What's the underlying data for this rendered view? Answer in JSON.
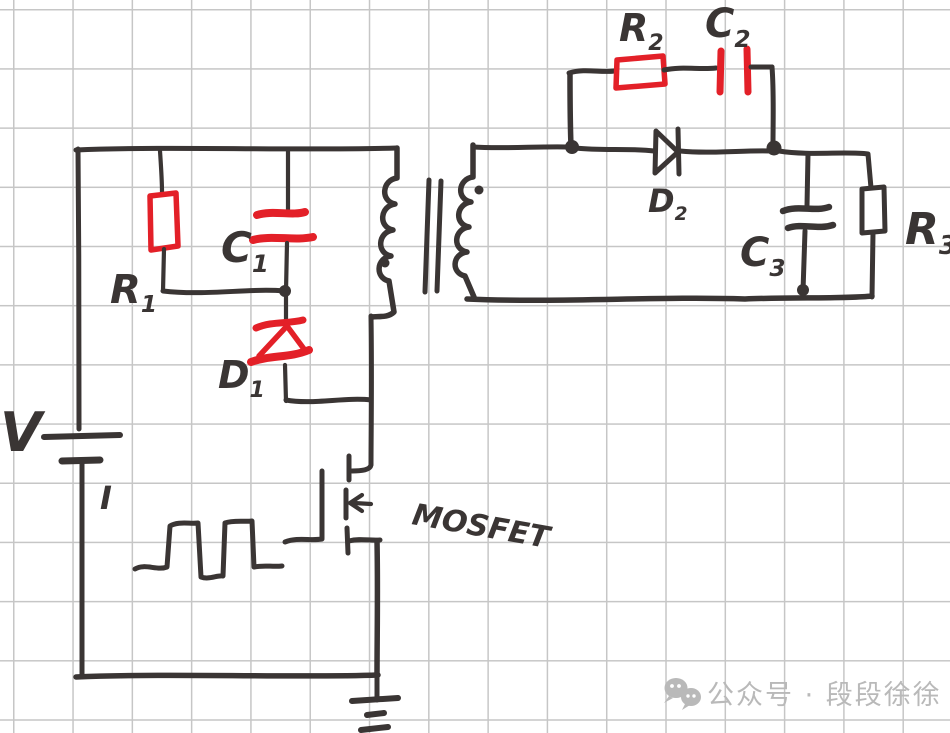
{
  "labels": {
    "v": "V",
    "i": "I",
    "r1": {
      "main": "R",
      "sub": "1"
    },
    "c1": {
      "main": "C",
      "sub": "1"
    },
    "d1": {
      "main": "D",
      "sub": "1"
    },
    "r2": {
      "main": "R",
      "sub": "2"
    },
    "c2": {
      "main": "C",
      "sub": "2"
    },
    "d2": {
      "main": "D",
      "sub": "2"
    },
    "c3": {
      "main": "C",
      "sub": "3"
    },
    "r3": {
      "main": "R",
      "sub": "3"
    },
    "mosfet": "MOSFET"
  },
  "components": [
    {
      "label": "V",
      "kind": "dc-voltage-source-battery"
    },
    {
      "label": "R1",
      "kind": "resistor",
      "highlighted_red": true
    },
    {
      "label": "C1",
      "kind": "capacitor",
      "highlighted_red": true
    },
    {
      "label": "D1",
      "kind": "zener-diode",
      "highlighted_red": true
    },
    {
      "label": "T",
      "kind": "transformer-two-windings-with-phase-dots"
    },
    {
      "label": "Q",
      "kind": "n-mosfet-with-gate-pulse-drive"
    },
    {
      "label": "R2",
      "kind": "resistor",
      "highlighted_red": true
    },
    {
      "label": "C2",
      "kind": "capacitor",
      "highlighted_red": true
    },
    {
      "label": "D2",
      "kind": "diode"
    },
    {
      "label": "C3",
      "kind": "capacitor"
    },
    {
      "label": "R3",
      "kind": "resistor"
    },
    {
      "label": "GND",
      "kind": "ground-symbol"
    }
  ],
  "colors": {
    "ink": "#3a3534",
    "highlight_red": "#e32028",
    "grid": "#c6c6c6",
    "paper": "#ffffff",
    "watermark": "#b9b9b9"
  },
  "watermark": {
    "icon": "wechat-icon",
    "text": "公众号 · 段段徐徐"
  }
}
